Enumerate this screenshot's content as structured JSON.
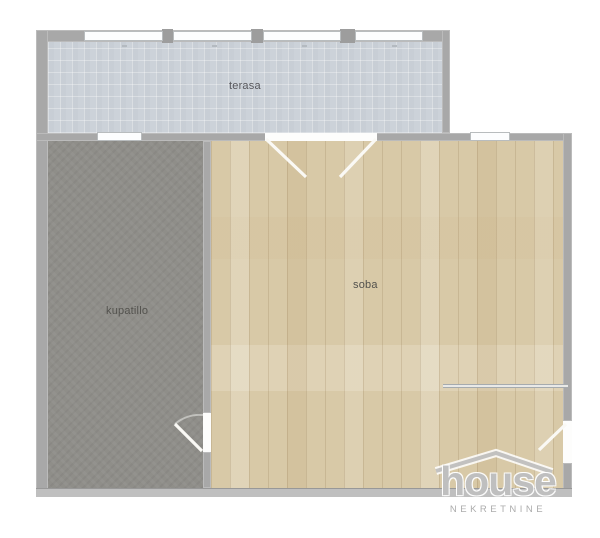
{
  "plan": {
    "title": "apartment-floor-plan",
    "rooms": {
      "terasa": {
        "label": "terasa"
      },
      "kupatilo": {
        "label": "kupatillo"
      },
      "soba": {
        "label": "soba"
      }
    },
    "colors": {
      "wall": "#a8a8a8",
      "terasa_floor": "#ccd2d9",
      "kupatillo_floor": "#8f8e89",
      "soba_floor": "#d8c9a7",
      "background": "#ffffff",
      "label_text": "#53524e"
    }
  },
  "watermark": {
    "title": "house",
    "subtitle": "NEKRETNINE"
  }
}
